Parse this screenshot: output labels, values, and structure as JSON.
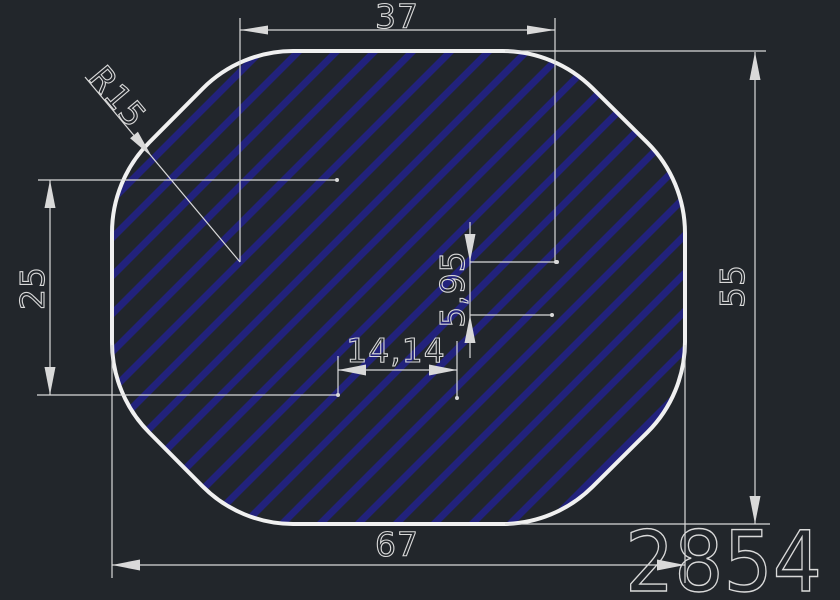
{
  "canvas": {
    "background_color": "#22262b",
    "outline_color": "#f0f0f0",
    "dimension_color": "#d9d9d9",
    "hatch_color": "#22227c"
  },
  "drawing": {
    "part_number": "2854",
    "dimensions": {
      "top_width": "37",
      "corner_radius": "R15",
      "left_height": "25",
      "inner_vertical": "5,95",
      "inner_horizontal": "14,14",
      "overall_width": "67",
      "overall_height": "55"
    }
  }
}
